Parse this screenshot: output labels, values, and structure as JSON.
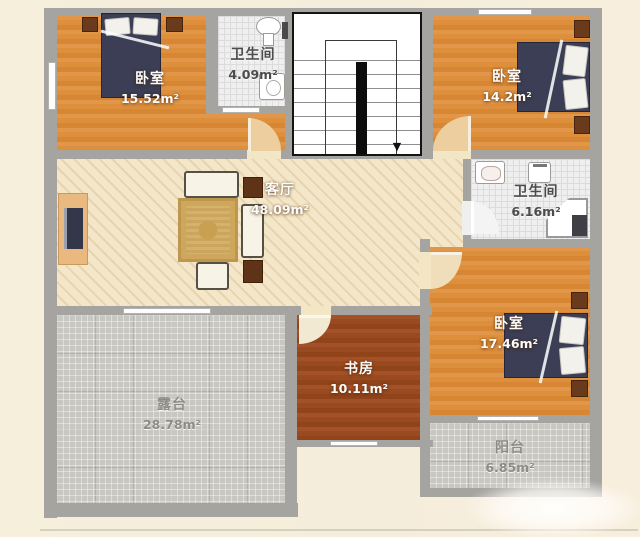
{
  "rooms": [
    {
      "key": "bedroom_top_left",
      "name": "卧室",
      "area": "15.52m²"
    },
    {
      "key": "bathroom_top",
      "name": "卫生间",
      "area": "4.09m²"
    },
    {
      "key": "bedroom_top_right",
      "name": "卧室",
      "area": "14.2m²"
    },
    {
      "key": "living_room",
      "name": "客厅",
      "area": "48.09m²"
    },
    {
      "key": "bathroom_right",
      "name": "卫生间",
      "area": "6.16m²"
    },
    {
      "key": "bedroom_bottom_right",
      "name": "卧室",
      "area": "17.46m²"
    },
    {
      "key": "study",
      "name": "书房",
      "area": "10.11m²"
    },
    {
      "key": "terrace",
      "name": "露台",
      "area": "28.78m²"
    },
    {
      "key": "balcony",
      "name": "阳台",
      "area": "6.85m²"
    }
  ],
  "icons": {
    "stair_down_arrow": "▼"
  },
  "colors": {
    "background": "#f6efdc",
    "wall": "#a5a4a1",
    "wood_floor": "#dd8f3c",
    "study_floor": "#9a4a20",
    "living_floor": "#f4e7c9",
    "bath_tile": "#efefef",
    "outdoor_tile": "#c9c7c2",
    "bed": "#3b3e54",
    "furniture_dark": "#5e3317",
    "label_white": "#fdfdfd",
    "label_dark": "#4c4c4c",
    "label_gray": "#8e8c88"
  }
}
